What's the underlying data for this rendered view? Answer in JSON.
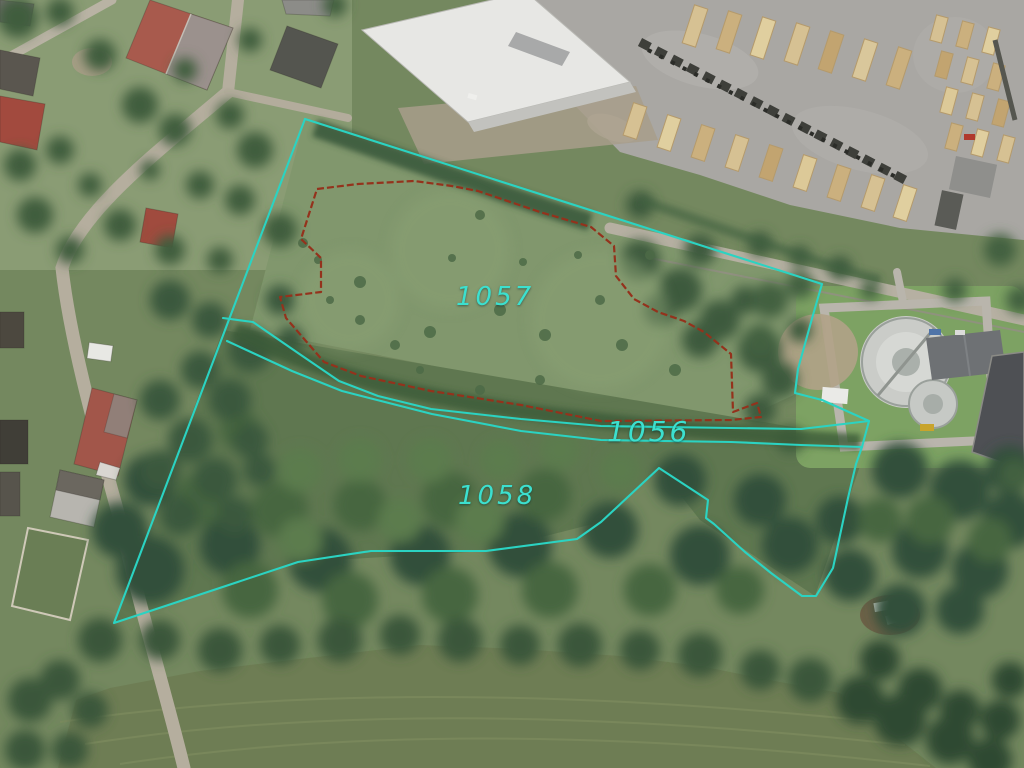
{
  "app": {
    "type": "aerial-cadastral-map",
    "description": "Satellite orthophoto with cadastral parcel boundary overlay"
  },
  "overlay": {
    "line_color": "#2bd3c2",
    "red_line_color": "#94321c",
    "label_color": "#3ce0cf",
    "outer_boundary_points": "305,119 822,284 813,315 798,369 795,393 822,400 869,421 862,447 856,464 848,498 833,568 816,596 802,596 771,573 745,552 714,524 706,518 708,500 659,468 601,522 577,539 486,551 371,551 298,562 114,623",
    "strip_top_points": "223,318 253,322 298,353 339,381 378,396 431,409 521,419 601,426 731,428 801,429 869,421",
    "strip_bottom_points": "227,341 292,371 342,391 381,401 432,414 521,431 601,440 731,442 801,445 862,447",
    "parcel_1057_points": "317,189 358,184 414,181 452,186 478,191 540,212 591,227 614,246 616,276 634,299 658,312 684,321 704,332 731,354 733,412 757,403 761,417 731,420 601,421 521,405 431,391 361,376 324,362 286,318 280,297 321,292 321,258 301,239",
    "labels": [
      {
        "text": "1057",
        "parcel": "1057"
      },
      {
        "text": "1056",
        "parcel": "1056"
      },
      {
        "text": "1058",
        "parcel": "1058"
      }
    ]
  }
}
